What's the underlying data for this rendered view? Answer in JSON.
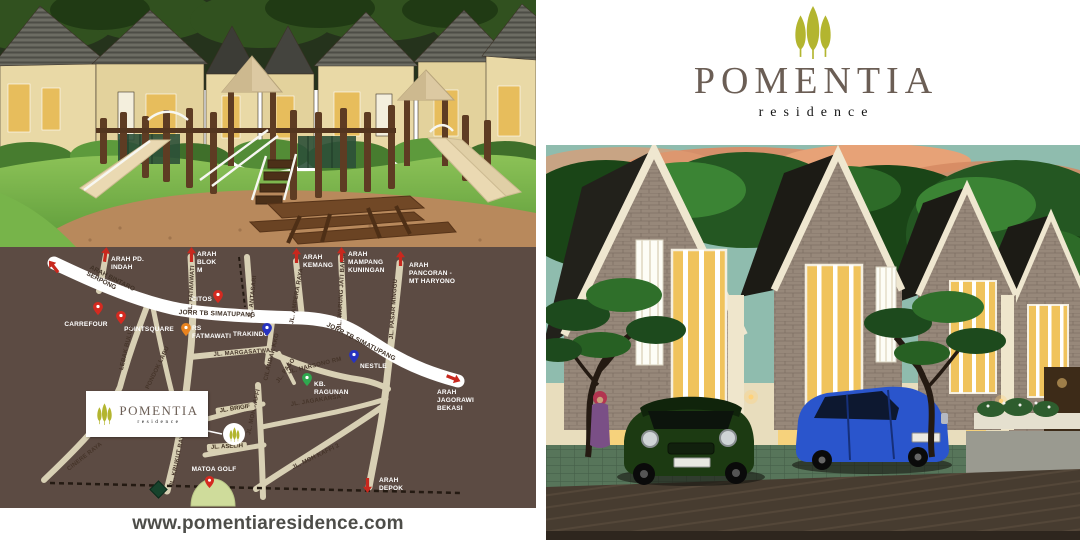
{
  "brand": {
    "name": "POMENTIA",
    "tagline": "residence",
    "website": "www.pomentiaresidence.com",
    "colors": {
      "tree_olive": "#b3b52f",
      "name_gray": "#6b5e55",
      "tagline_black": "#141414"
    }
  },
  "map": {
    "colors": {
      "background": "#5c4b43",
      "road": "#d8d0b4",
      "highway": "#ffffff",
      "pin_red": "#d42a20",
      "pin_orange": "#e8821e",
      "pin_blue": "#2733c0",
      "pin_green": "#2fa84f",
      "golf_green": "#cfdc9b"
    },
    "inset_logo": {
      "name": "POMENTIA",
      "tagline": "residence"
    },
    "directions": {
      "pd_indah": "ARAH PD. INDAH",
      "blok_m": "ARAH BLOK M",
      "kemang": "ARAH KEMANG",
      "mampang": "ARAH MAMPANG KUNINGAN",
      "pancoran": "ARAH PANCORAN - MT HARYONO",
      "jagorawi": "ARAH JAGORAWI BEKASI",
      "depok": "ARAH DEPOK",
      "bintaro": "ARAH BINTARO SERPONG"
    },
    "highways": {
      "jorr_west": "JORR TB SIMATUPANG",
      "jorr_east": "JORR TB SIMATUPANG"
    },
    "pois": {
      "carrefour": "CARREFOUR",
      "pointsquare": "POINTSQUARE",
      "citos": "CITOS",
      "rs_fatmawati": "RS FATMAWATI",
      "trakindo": "TRAKINDO",
      "nestle": "NESTLE",
      "kb_ragunan": "KB. RAGUNAN",
      "matoa_golf": "MATOA GOLF"
    },
    "roads": {
      "fatmawati": "JL. FATMAWATI",
      "antasari": "JL. ANTASARI",
      "ampera": "JL. AMPERA RAYA",
      "warung_jati": "JL. WARUNG JATI BARAT",
      "pasar_minggu": "JL. PASAR MINGGU",
      "margasatwa": "JL. MARGASATWA",
      "cilandak_kko": "CILANDAK KKO",
      "harsono": "JL. HARSONO RM",
      "paso": "JL. PASO",
      "lebak_bulus": "LEBAK BULUS",
      "pondok_labu": "PONDOK LABU",
      "krukut": "JL. KRUKUT RAYA",
      "cinere": "CINERE RAYA",
      "brigif": "JL. BRIGIF",
      "aselih": "JL. ASELIH",
      "moh_kaffi": "JL. MOH KAFFI",
      "moh_kaffi_2": "JL. MOH KAFFI 2",
      "jagakarsa": "JL. JAGAKARSA"
    }
  }
}
